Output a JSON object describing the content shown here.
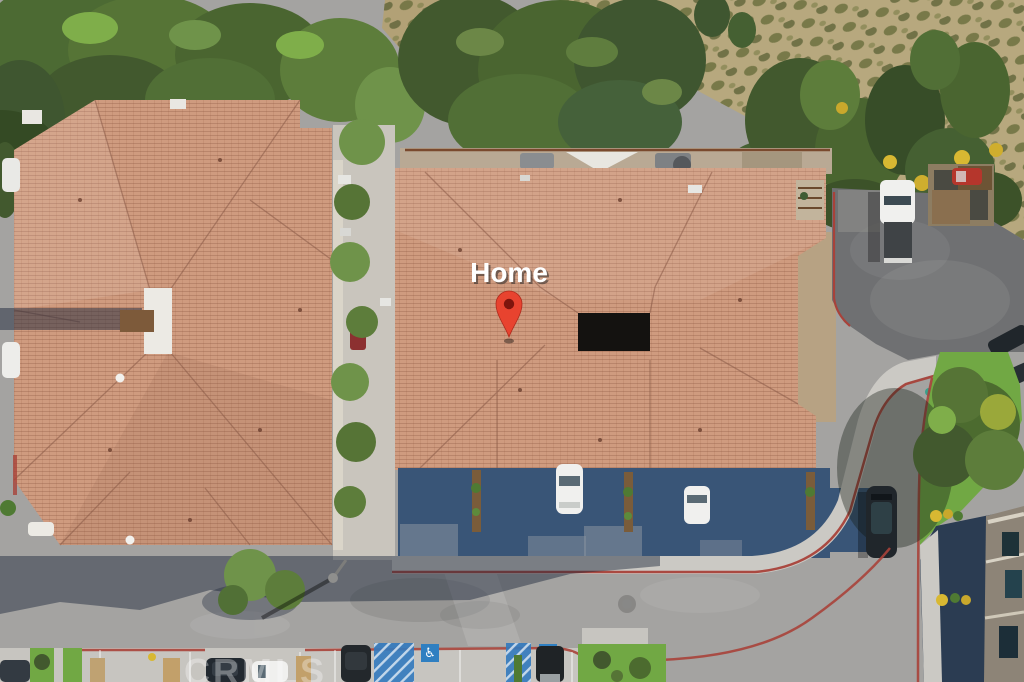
{
  "scene": {
    "home_label": "Home",
    "watermark": "CRMLS",
    "handicap_symbol": "♿"
  },
  "colors": {
    "pin_red": "#e8432f",
    "pin_hole": "#7e150d",
    "label_white": "#ffffff",
    "roof_tile": "#cf9b7f",
    "roof_line": "#8a5a47",
    "road": "#a4a3a1",
    "asphalt_lot": "#6f7072",
    "sidewalk": "#cbc9c4",
    "curb_red": "#a8423a",
    "driveway_shadow": "#395577",
    "building_shadow": "#2b3c52",
    "grass": "#71a844",
    "tree_green": "#4a6530",
    "hillside_tan": "#b7a87e",
    "scrub_olive": "#6d713f",
    "handicap_blue": "#3279be",
    "car_white": "#f0f0ee",
    "car_dark": "#20262b"
  }
}
